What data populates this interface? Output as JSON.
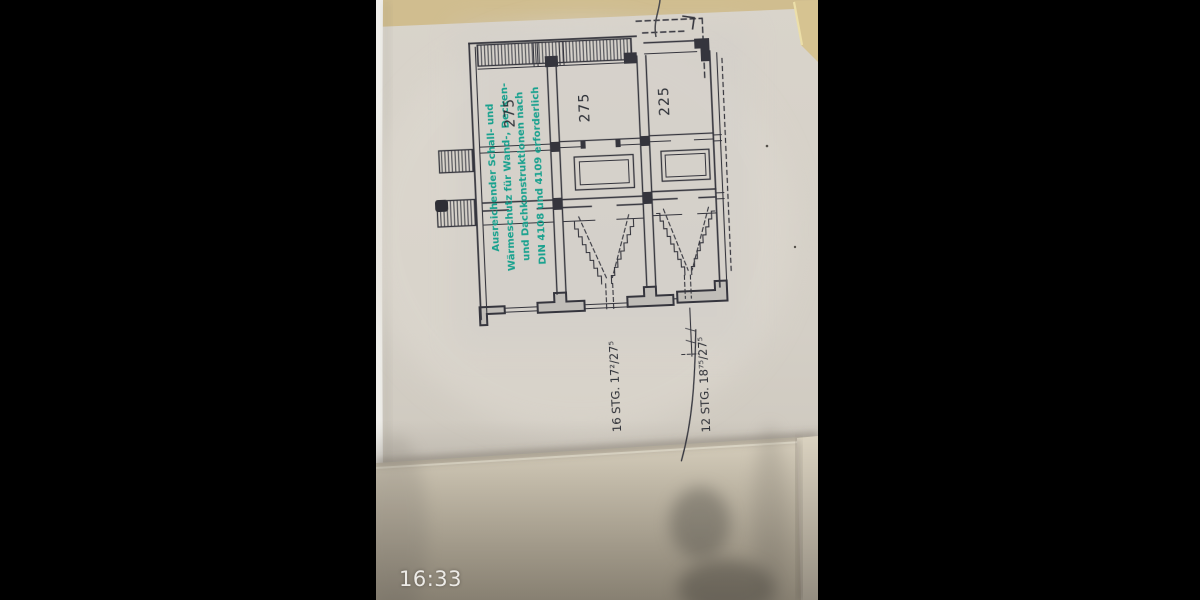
{
  "viewer": {
    "timestamp_overlay": "16:33"
  },
  "stamp": {
    "ink_color": "#129f8b",
    "lines": [
      "Ausreichender Schall- und",
      "Wärmeschutz für Wand-, Decken-",
      "und Dachkonstruktionen nach",
      "DIN 4108 und 4109 erforderlich"
    ]
  },
  "floor_plan": {
    "line_color": "#34353d",
    "room_labels": [
      "275",
      "275",
      "225"
    ],
    "stair_annotations": [
      "16 STG. 17²/27⁵",
      "12 STG. 18⁷⁵/27⁵"
    ]
  },
  "colors": {
    "letterbox": "#000000",
    "paper": "#d6d1c8",
    "paper_top_band": "#d0bd8f",
    "under_page": "#dbd3c1",
    "timestamp_text": "#eceae6"
  }
}
